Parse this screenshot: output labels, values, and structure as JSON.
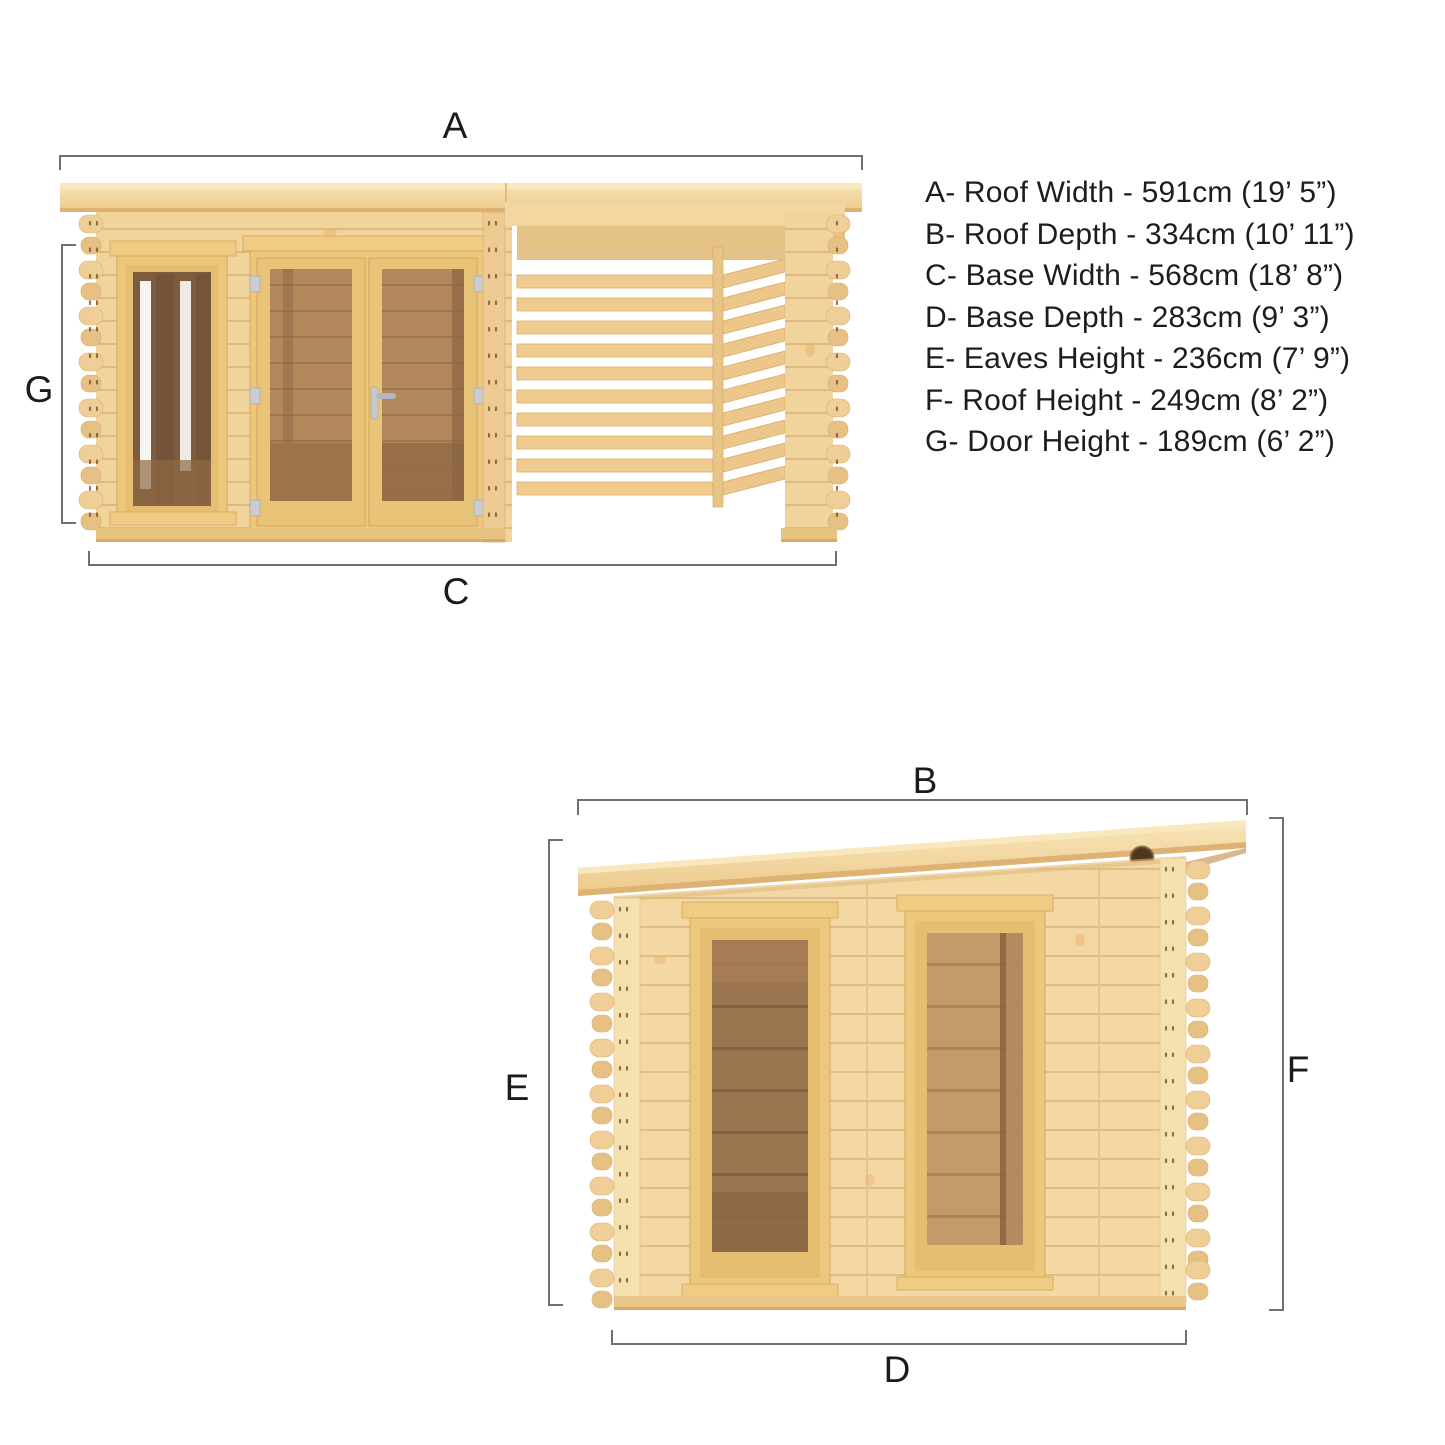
{
  "diagram_title": "Log cabin with pergola dimension diagram",
  "dimension_labels": {
    "a": "A",
    "b": "B",
    "c": "C",
    "d": "D",
    "e": "E",
    "f": "F",
    "g": "G"
  },
  "legend": {
    "items": [
      "A- Roof Width - 591cm (19’ 5”)",
      "B- Roof Depth - 334cm (10’ 11”)",
      "C- Base Width - 568cm (18’ 8”)",
      "D- Base Depth - 283cm (9’ 3”)",
      "E- Eaves Height - 236cm (7’ 9”)",
      "F- Roof Height - 249cm (8’ 2”)",
      "G- Door Height - 189cm (6’ 2”)"
    ]
  },
  "colors": {
    "wood_light": "#F7E2B2",
    "wood": "#F1D39C",
    "wood_mid": "#E8C483",
    "wood_dark": "#DDB273",
    "frame_gold": "#ECC77C",
    "glass_dark": "#7C5B3F",
    "glass_medium": "#9B7450",
    "glass_light": "#C39A69",
    "interior_wood": "#B1875B",
    "knot_hole": "#4E371F",
    "dimension_line": "#6F6F6F",
    "label_text": "#1B1B1B"
  }
}
